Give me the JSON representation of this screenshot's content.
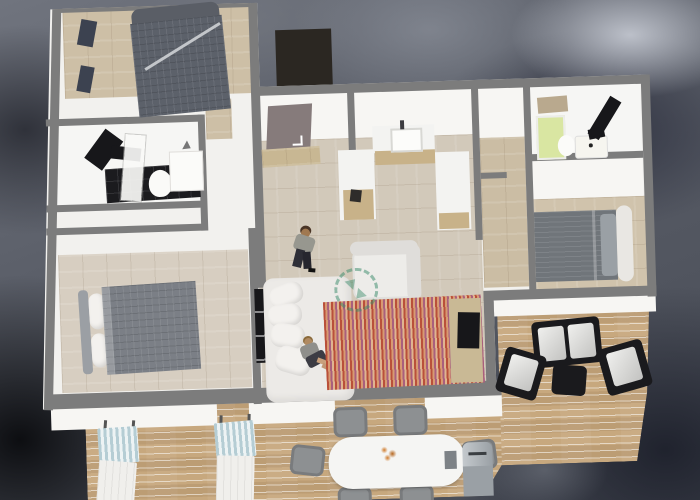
{
  "scene": {
    "type": "3d-floorplan-render",
    "description": "Top-down 3D rendering of an apartment with wrap-around wooden terrace on a dark blurred background",
    "watermark_icon": "rotate-arrows-dashed-circle",
    "palette": {
      "wall": "#7c7c7c",
      "building": "#f2f1ee",
      "woodBedA": "#cdbfa6",
      "woodBedB": "#d7cec1",
      "woodMain": "#d2c9ba",
      "woodCorridor": "#cbbda4",
      "woodBedC": "#d0c3ac",
      "deck": "#c7a87e",
      "counterTan": "#c8b289",
      "door": "#867b7b",
      "darkPatch": "#2b2722",
      "fixtureBlack": "#17171a",
      "bedADuvet": "#5c616a",
      "bedBDuvet": "#7b7f86",
      "bedCDuvet": "#70757a",
      "sofaWhite": "#eceae7",
      "rugA": "#b9503a",
      "rugB": "#d89a72",
      "rugC": "#a95f7d",
      "rugD": "#e0b490",
      "shower": "#d9e6a2",
      "watermarkGreen": "#3a8a6a",
      "outdoorBlack": "#1a1a1d",
      "cushion": "#e4e4e2",
      "chairGray": "#8d9092",
      "tableWhite": "#f5f5f3",
      "flowerOrange": "#cf7a2a",
      "grillSilver": "#9aa0a5",
      "loungerBlue": "#b5cdd4"
    },
    "rooms": [
      {
        "name": "bedroom-top-left",
        "floor": "wood",
        "furniture": [
          "double-bed-dark-plaid"
        ]
      },
      {
        "name": "bathroom-left",
        "floor": "white-with-black-tiles",
        "furniture": [
          "black-vanity",
          "glass-shower-panel",
          "toilet",
          "counter"
        ]
      },
      {
        "name": "bedroom-bottom-left",
        "floor": "wood",
        "furniture": [
          "double-bed-gray-plaid"
        ]
      },
      {
        "name": "entrance-hall",
        "floor": "wood",
        "furniture": [
          "entrance-door",
          "stool"
        ]
      },
      {
        "name": "kitchen",
        "floor": "wood",
        "furniture": [
          "u-shaped-counter",
          "sink",
          "coffee-maker"
        ]
      },
      {
        "name": "living-room",
        "floor": "wood",
        "furniture": [
          "sofa",
          "armchair",
          "striped-rug",
          "tv-panel",
          "sideboard-tv"
        ]
      },
      {
        "name": "corridor",
        "floor": "wood",
        "furniture": []
      },
      {
        "name": "bathroom-right",
        "floor": "white",
        "furniture": [
          "green-shower",
          "toilet",
          "sink",
          "black-shelf"
        ]
      },
      {
        "name": "bedroom-right",
        "floor": "wood",
        "furniture": [
          "double-bed-gray-striped"
        ]
      },
      {
        "name": "terrace-deck",
        "floor": "wood-planks",
        "furniture": [
          "sun-lounger",
          "sun-lounger",
          "dining-table",
          "dining-chairs-6",
          "flower-centerpiece",
          "grill",
          "outdoor-loveseat",
          "outdoor-chair",
          "outdoor-chair",
          "ottoman"
        ]
      }
    ],
    "people": [
      {
        "pose": "standing",
        "location": "hallway-living-room"
      },
      {
        "pose": "sitting",
        "location": "sofa"
      }
    ]
  }
}
